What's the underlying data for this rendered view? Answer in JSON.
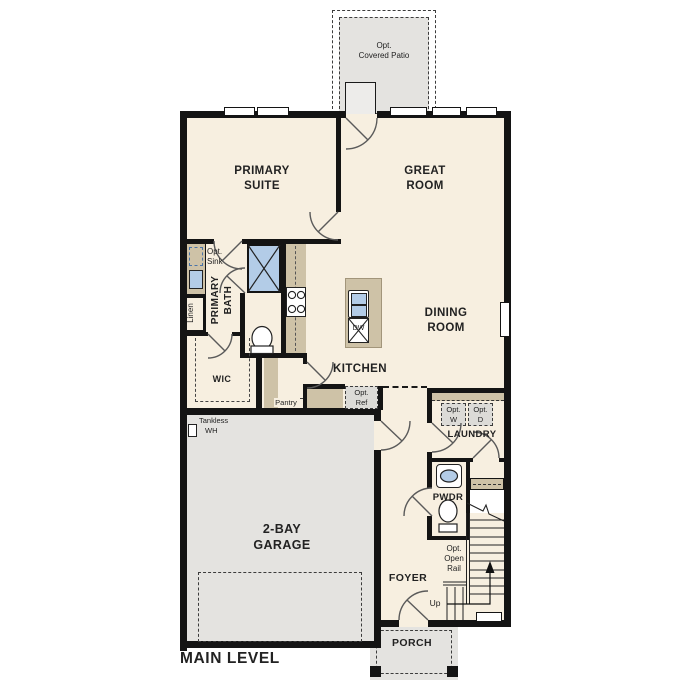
{
  "title": "MAIN LEVEL",
  "colors": {
    "room_fill": "#f7efe0",
    "garage_fill": "#e4e3e0",
    "counter_tan": "#cec2a7",
    "fixture_blue": "#b3cce7",
    "wall": "#141414"
  },
  "rooms": {
    "patio": {
      "line1": "Opt.",
      "line2": "Covered Patio"
    },
    "primary_suite": {
      "line1": "PRIMARY",
      "line2": "SUITE"
    },
    "great_room": {
      "line1": "GREAT",
      "line2": "ROOM"
    },
    "dining_room": {
      "line1": "DINING",
      "line2": "ROOM"
    },
    "kitchen": {
      "label": "KITCHEN"
    },
    "primary_bath": {
      "line1": "PRIMARY",
      "line2": "BATH"
    },
    "linen": {
      "label": "Linen"
    },
    "wic": {
      "label": "WIC"
    },
    "pantry": {
      "label": "Pantry"
    },
    "laundry": {
      "label": "LAUNDRY"
    },
    "pwdr": {
      "label": "PWDR"
    },
    "foyer": {
      "label": "FOYER"
    },
    "garage": {
      "line1": "2-BAY",
      "line2": "GARAGE"
    },
    "porch": {
      "label": "PORCH"
    }
  },
  "annotations": {
    "opt_sink": {
      "line1": "Opt.",
      "line2": "Sink"
    },
    "opt_ref": {
      "line1": "Opt.",
      "line2": "Ref"
    },
    "opt_washer": {
      "line1": "Opt.",
      "line2": "W"
    },
    "opt_dryer": {
      "line1": "Opt.",
      "line2": "D"
    },
    "tankless_wh": {
      "line1": "Tankless",
      "line2": "WH"
    },
    "opt_open_rail": {
      "line1": "Opt.",
      "line2": "Open",
      "line3": "Rail"
    },
    "up": {
      "label": "Up"
    },
    "dishwasher": {
      "label": "DW"
    }
  }
}
